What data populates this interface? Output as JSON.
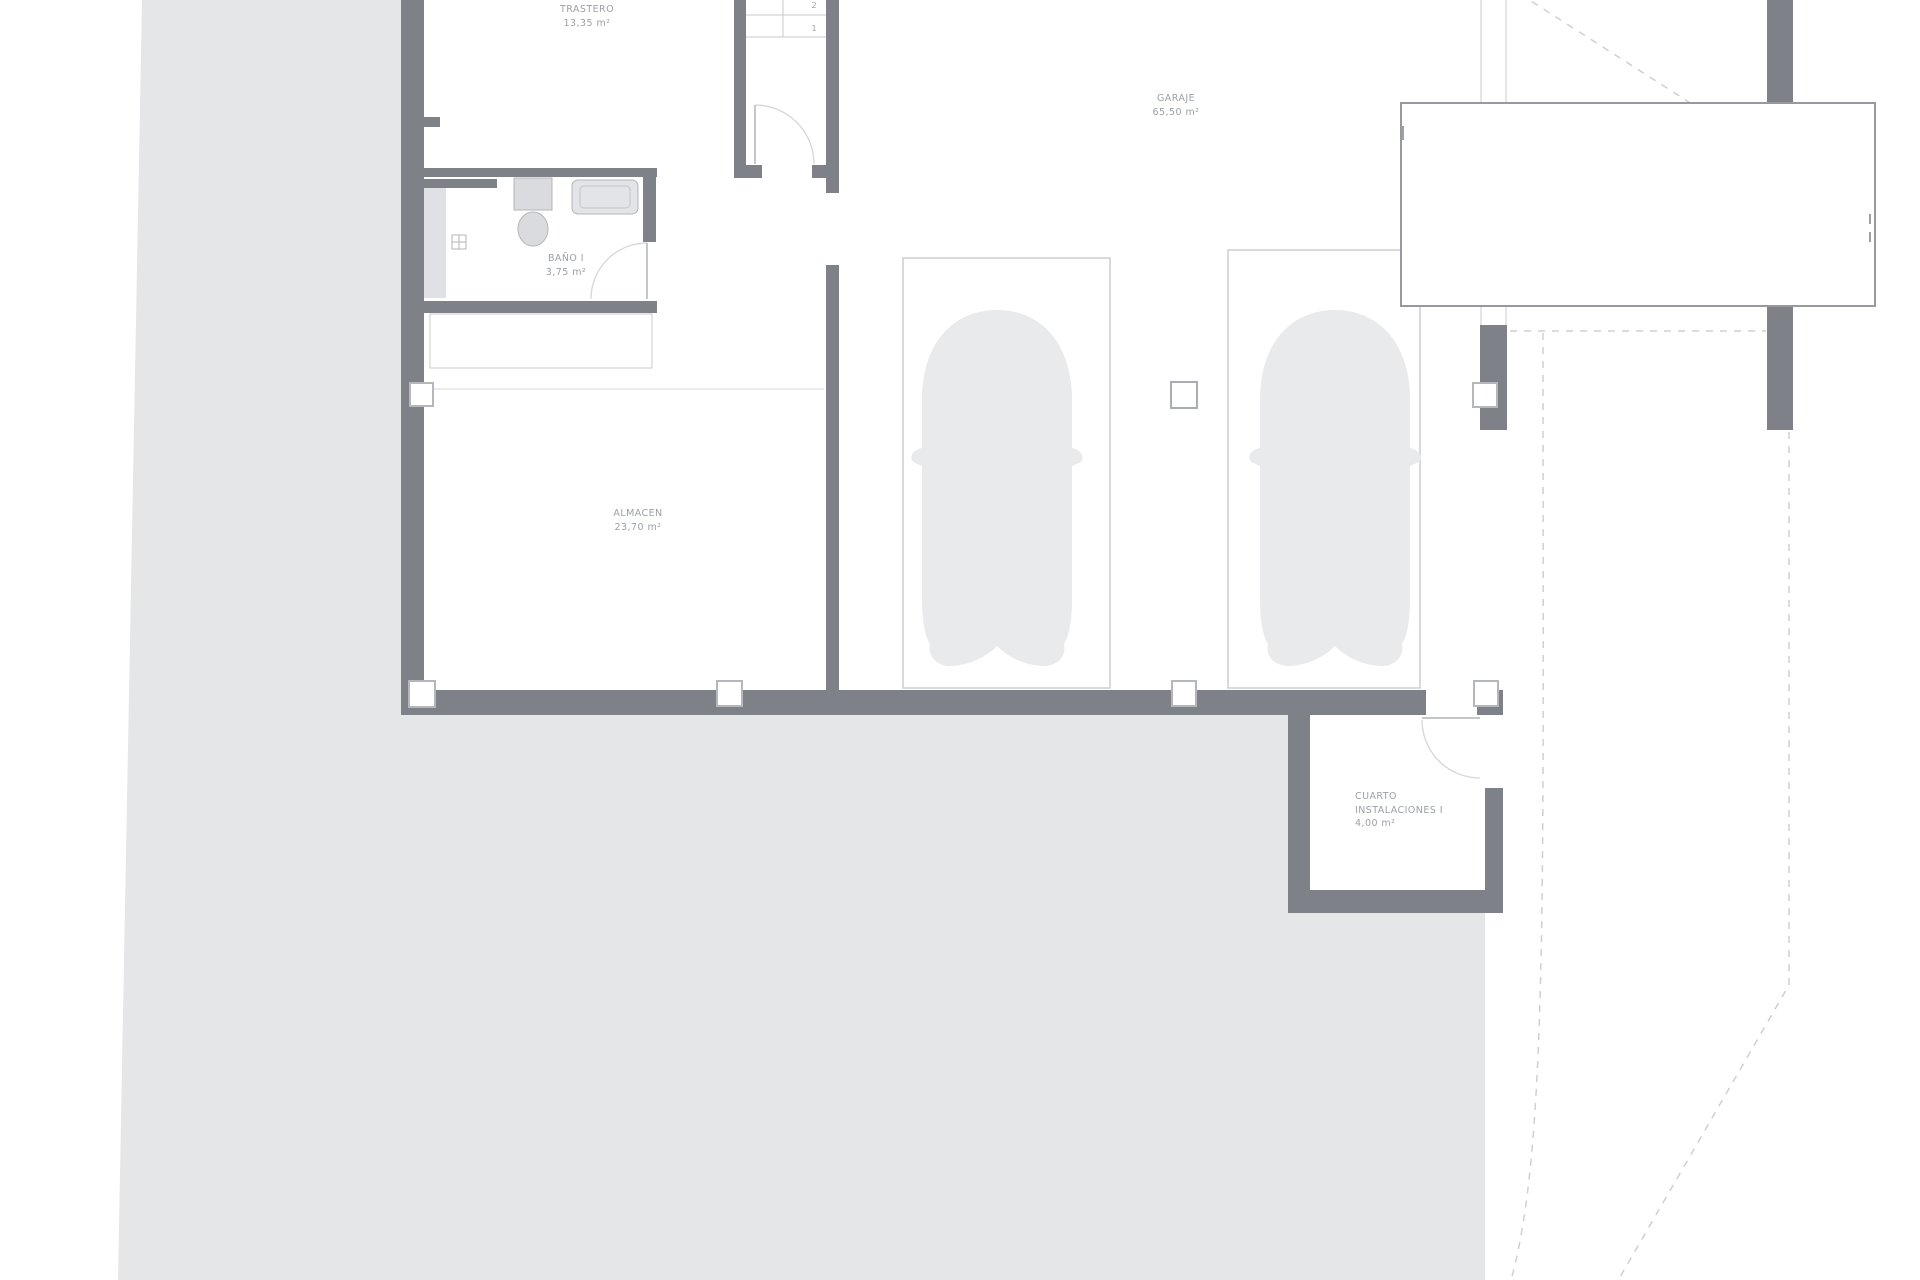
{
  "meta": {
    "drawing_type": "architectural floor plan",
    "level": "basement / garage"
  },
  "rooms": {
    "trastero": {
      "name": "TRASTERO",
      "area": "13,35 m²"
    },
    "garaje": {
      "name": "GARAJE",
      "area": "65,50 m²"
    },
    "bano": {
      "name": "BAÑO I",
      "area": "3,75 m²"
    },
    "almacen": {
      "name": "ALMACEN",
      "area": "23,70 m²"
    },
    "cuarto": {
      "name_line1": "CUARTO",
      "name_line2": "INSTALACIONES I",
      "area": "4,00 m²"
    }
  },
  "stairs": {
    "step1": "2",
    "step2": "1"
  },
  "colors": {
    "wall": "#7e8187",
    "terrain": "#e5e6e8",
    "thin_outline": "#c9cbce",
    "door_arc": "#d4d6d8",
    "label_text": "#9ba0a6",
    "car_fill": "#e9eaeb",
    "title_box_border": "#97999f"
  }
}
